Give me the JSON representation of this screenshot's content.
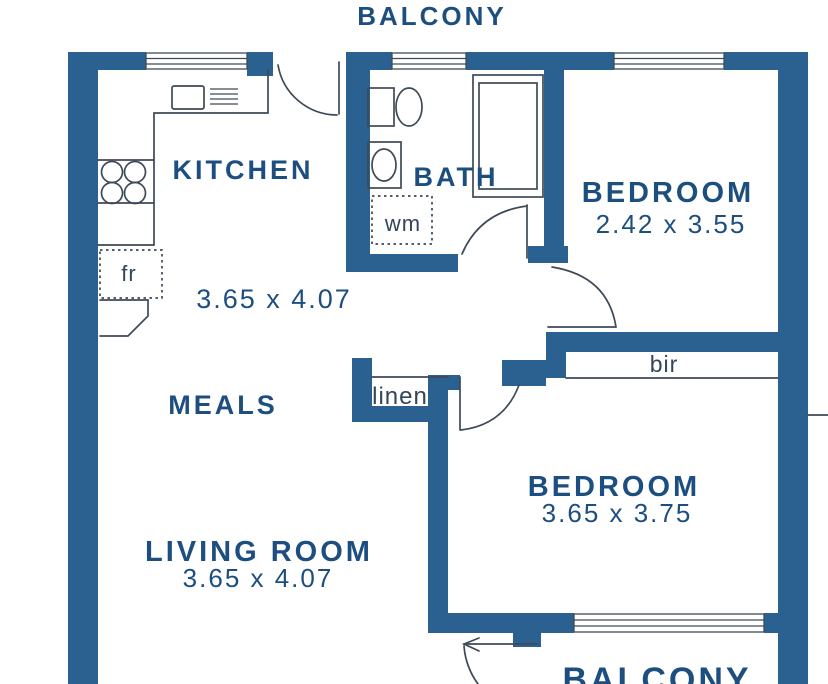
{
  "colors": {
    "wall": "#2b6191",
    "label": "#1d4e80",
    "annot": "#32455a",
    "line": "#3e4a57",
    "bg": "#ffffff"
  },
  "plan": {
    "balcony_top": "BALCONY",
    "balcony_bottom": "BALCONY",
    "kitchen": {
      "name": "KITCHEN"
    },
    "kitchen_meals_area": {
      "dimensions": "3.65 x 4.07"
    },
    "bath": {
      "name": "BATH"
    },
    "bedroom_1": {
      "name": "BEDROOM",
      "dimensions": "2.42 x 3.55"
    },
    "meals": {
      "name": "MEALS"
    },
    "bedroom_2": {
      "name": "BEDROOM",
      "dimensions": "3.65 x 3.75"
    },
    "living_room": {
      "name": "LIVING ROOM",
      "dimensions": "3.65 x 4.07"
    },
    "fixtures": {
      "linen_closet": "linen",
      "washing_machine": "wm",
      "fridge": "fr",
      "built_in_robe": "bir"
    }
  }
}
